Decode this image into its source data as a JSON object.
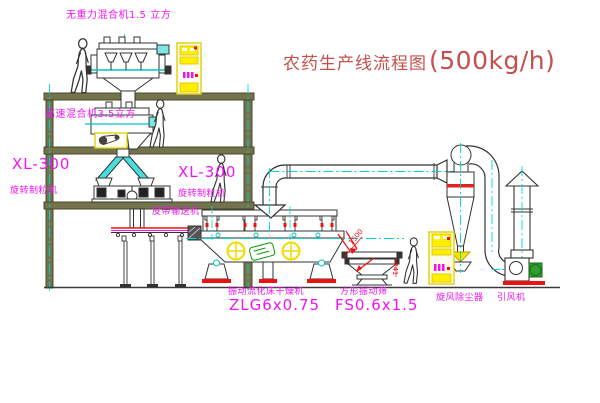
{
  "title": {
    "name_cn": "农药生产线流程图",
    "capacity": "(500kg/h)"
  },
  "labels": {
    "mixer_top": "无重力混合机1.5 立方",
    "mixer_2f": "高速混合机3.5立方",
    "granulator_model_left": "XL-300",
    "granulator_name_left": "旋转制粒机",
    "granulator_model_mid": "XL-300",
    "granulator_name_mid": "旋转制粒机",
    "belt_conveyor": "皮带输送机",
    "dryer_name": "振动流化床干燥机",
    "dryer_model": "ZLG6x0.75",
    "sieve_name": "方形振动筛",
    "sieve_model": "FS0.6x1.5",
    "cyclone": "旋风除尘器",
    "fan": "引风机"
  },
  "dimensions": {
    "sieve_length": "1500",
    "sieve_height": "741"
  },
  "colors": {
    "label_magenta": "#f213f2",
    "title_red": "#c2504e",
    "detail_red": "#ee1111",
    "centerline_cyan": "#00d5d5",
    "cabinet_yellow": "#ffee00",
    "motor_green": "#2e9e2e",
    "structure_olive": "#6b6b4a"
  }
}
